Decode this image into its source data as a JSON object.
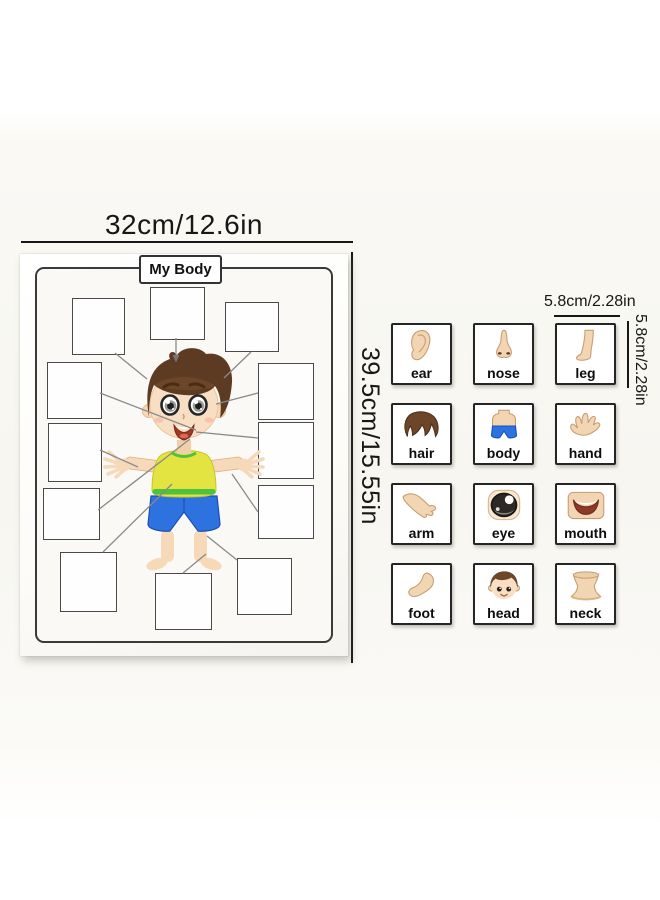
{
  "poster": {
    "title": "My Body",
    "width_label": "32cm/12.6in",
    "height_label": "39.5cm/15.55in"
  },
  "cards": {
    "width_label": "5.8cm/2.28in",
    "height_label": "5.8cm/2.28in",
    "items": [
      {
        "label": "ear"
      },
      {
        "label": "nose"
      },
      {
        "label": "leg"
      },
      {
        "label": "hair"
      },
      {
        "label": "body"
      },
      {
        "label": "hand"
      },
      {
        "label": "arm"
      },
      {
        "label": "eye"
      },
      {
        "label": "mouth"
      },
      {
        "label": "foot"
      },
      {
        "label": "head"
      },
      {
        "label": "neck"
      }
    ]
  },
  "colors": {
    "skin": "#f2d5b2",
    "skin_outline": "#c79b72",
    "hair_brown": "#6b4629",
    "shirt_yellow": "#e3e342",
    "trim_green": "#4fc13c",
    "shorts_blue": "#2e72e0",
    "connector_gray": "#8a8a8a",
    "ink_black": "#171717"
  }
}
